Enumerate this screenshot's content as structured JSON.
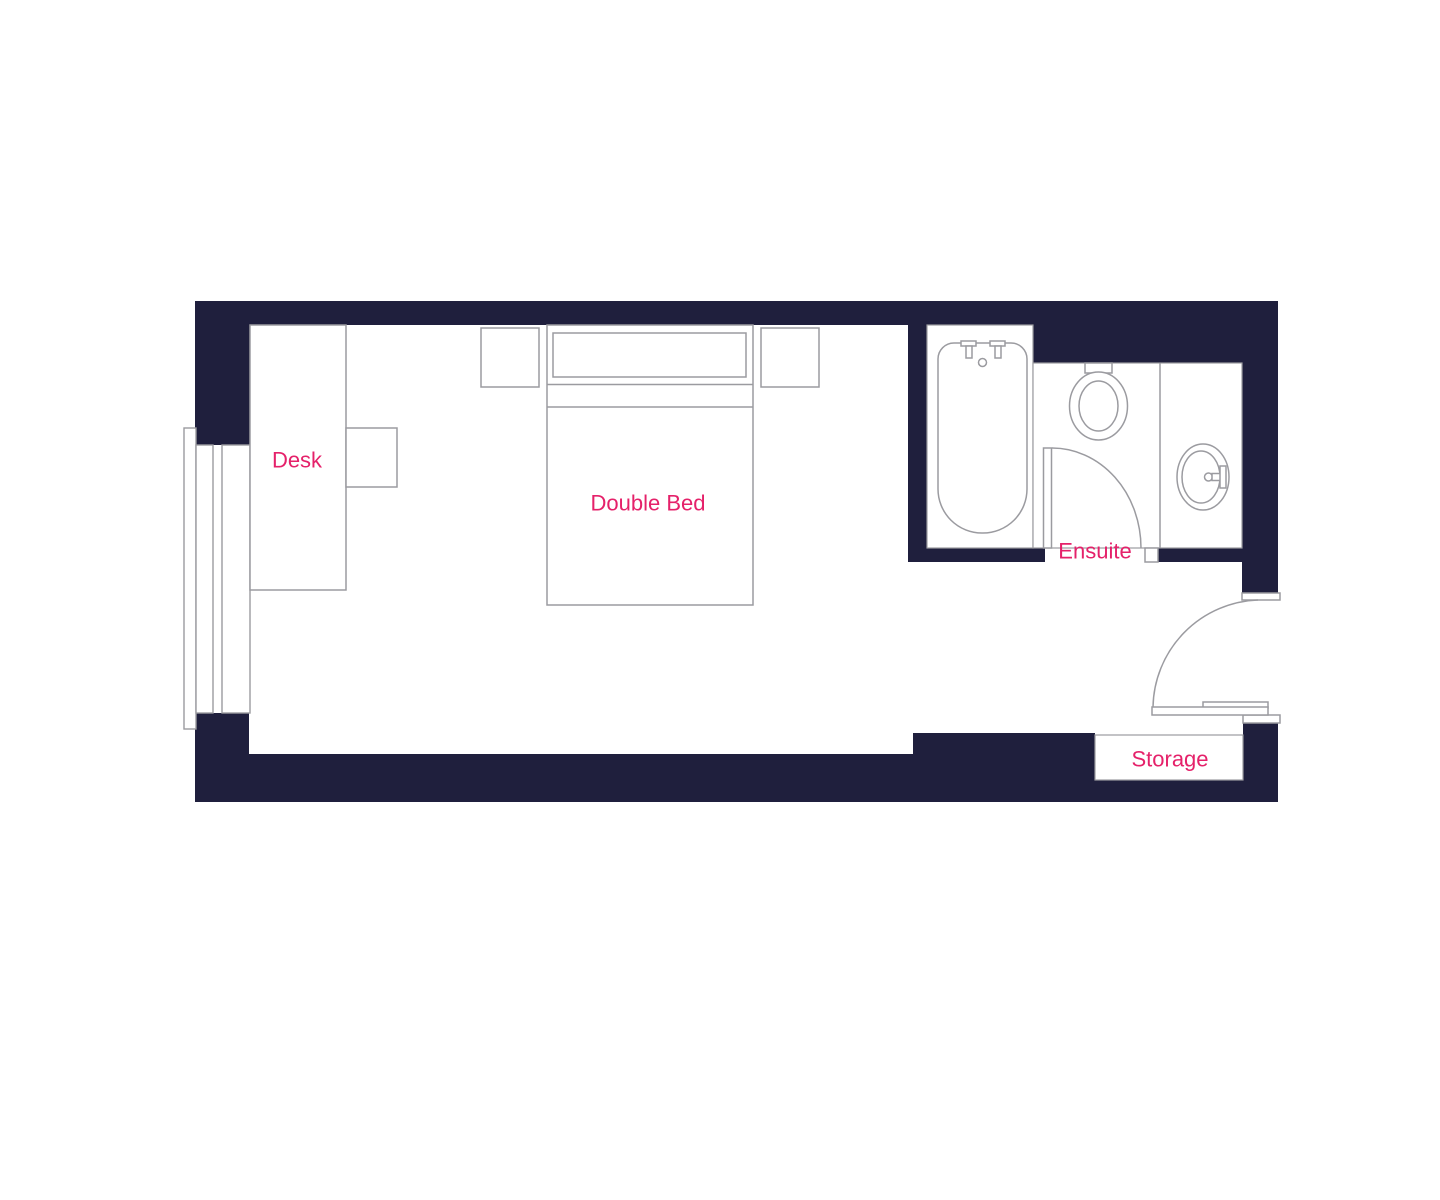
{
  "colors": {
    "wall": "#1F1F3D",
    "outline": "#9B9BA0",
    "fixture_fill": "#FFFFFF",
    "label": "#E5216A",
    "background": "#FFFFFF"
  },
  "labels": {
    "desk": "Desk",
    "double_bed": "Double Bed",
    "ensuite": "Ensuite",
    "storage": "Storage"
  }
}
